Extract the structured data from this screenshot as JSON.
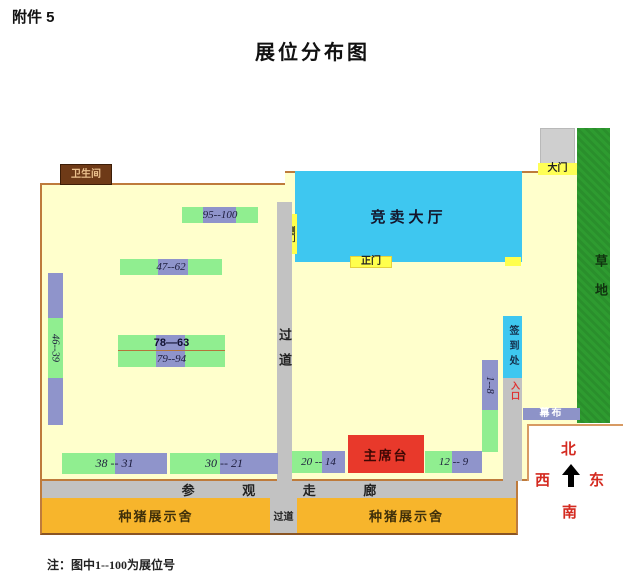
{
  "page": {
    "attachment": "附件 5",
    "title": "展位分布图",
    "footnote": "注：图中1--100为展位号"
  },
  "facilities": {
    "restroom": "卫生间",
    "gate": "大门",
    "grass": "草地",
    "auction_hall": "竞卖大厅",
    "main_door": "正门",
    "side_door": "侧门",
    "center_aisle": "过道",
    "signin_desk": "签到处",
    "entrance": "入口",
    "curtain": "幕布",
    "podium": "主席台",
    "walkway": "参 观 走 廊",
    "pig_house_left": "种猪展示舍",
    "pig_house_right": "种猪展示舍",
    "bottom_aisle": "过道"
  },
  "compass": {
    "north": "北",
    "south": "南",
    "east": "东",
    "west": "西"
  },
  "booths": {
    "b95_100": "95--100",
    "b47_62": "47--62",
    "b78_63": "78—63",
    "b79_94": "79--94",
    "b46_39": "46--39",
    "b38_31": "38 -- 31",
    "b30_21": "30 -- 21",
    "b20_14": "20 -- 14",
    "b12_9": "12 -- 9",
    "b1_8": "1--8"
  },
  "colors": {
    "map_bg": "#FFFFCC",
    "boundary_brown": "#BE7B3C",
    "hall_cyan": "#3EC7F0",
    "booth_green": "#90EE90",
    "booth_purple": "#8F94CB",
    "aisle_gray": "#C2C2C2",
    "pig_house_orange": "#F7B52C",
    "podium_red": "#E8392B",
    "grass_green": "#2E9B30",
    "door_yellow": "#FFFF4D",
    "restroom_brown": "#6E3A17",
    "curtain_purple": "#8D93C8",
    "compass_red": "#D42A20"
  }
}
